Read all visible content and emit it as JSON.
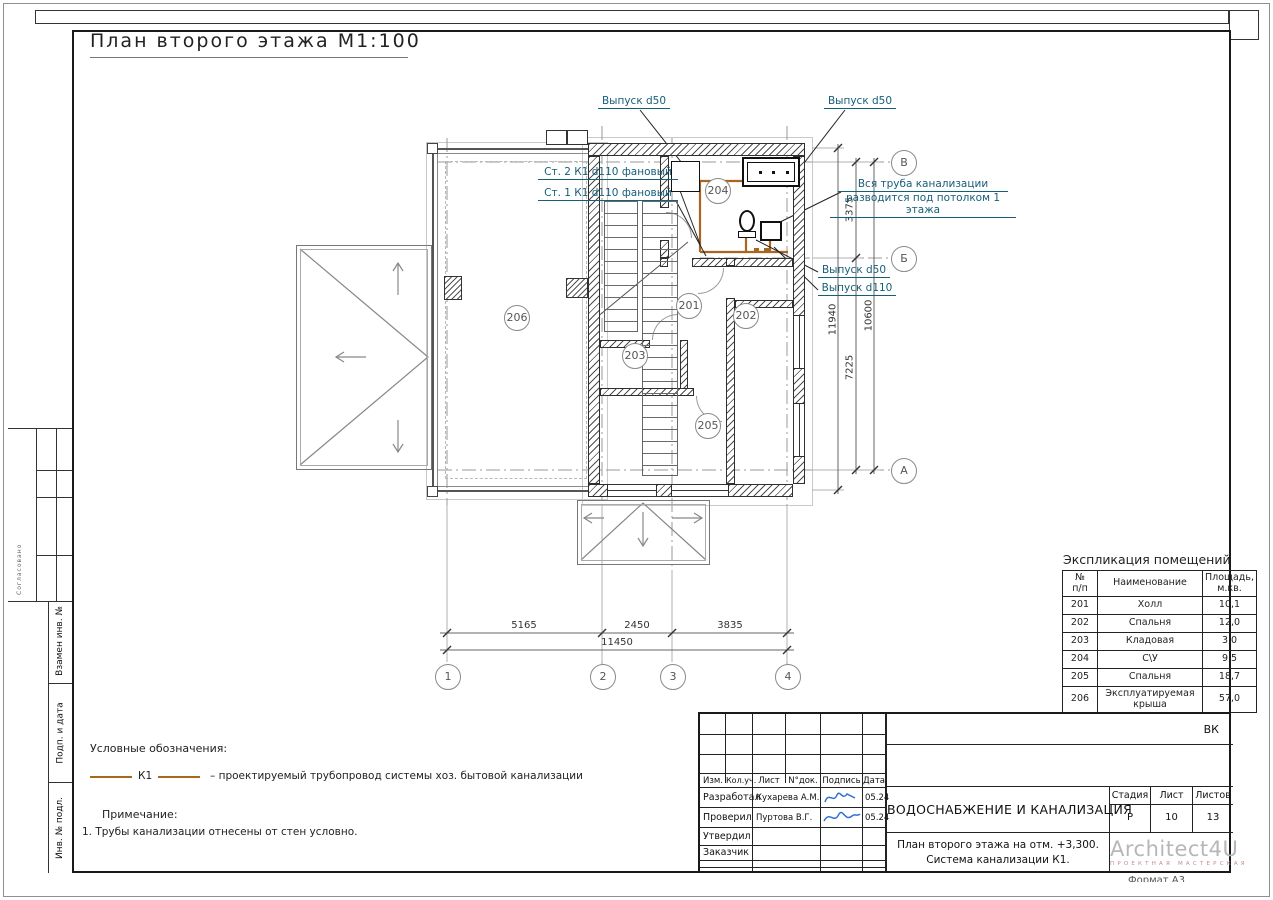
{
  "page": {
    "title": "План второго этажа М1:100",
    "format_note": "Формат А3"
  },
  "colors": {
    "pipe": "#a8671f",
    "annotation": "#155e78",
    "signature": "#2f6fd6",
    "logo_gray": "#b7b7b7",
    "logo_red": "#c48b8b"
  },
  "plan": {
    "rooms": {
      "r201": "201",
      "r202": "202",
      "r203": "203",
      "r204": "204",
      "r205": "205",
      "r206": "206"
    },
    "axes": {
      "c1": "1",
      "c2": "2",
      "c3": "3",
      "c4": "4",
      "rA": "А",
      "rB": "Б",
      "rV": "В"
    },
    "dims": {
      "b1": "5165",
      "b2": "2450",
      "b3": "3835",
      "btotal": "11450",
      "v1": "3375",
      "v2": "7225",
      "vtotal": "10600",
      "vouter": "11940"
    },
    "annotations": {
      "outlet50_left": "Выпуск d50",
      "outlet50_right": "Выпуск d50",
      "riser2": "Ст. 2 К1 d110 фановый",
      "riser1": "Ст. 1 К1 d110 фановый",
      "ceiling_note1": "Вся труба канализации",
      "ceiling_note2": "разводится под потолком 1 этажа",
      "outlet50_mid": "Выпуск d50",
      "outlet110": "Выпуск d110"
    }
  },
  "legend": {
    "heading": "Условные обозначения:",
    "k1_label": "К1",
    "k1_desc": "– проектируемый трубопровод системы хоз. бытовой канализации",
    "note_heading": "Примечание:",
    "note1": "1. Трубы канализации отнесены  от стен условно."
  },
  "explication": {
    "title": "Экспликация помещений",
    "headers": {
      "num": "№\nп/п",
      "name": "Наименование",
      "area": "Площадь,\nм.кв."
    },
    "rows": [
      {
        "num": "201",
        "name": "Холл",
        "area": "10,1"
      },
      {
        "num": "202",
        "name": "Спальня",
        "area": "12,0"
      },
      {
        "num": "203",
        "name": "Кладовая",
        "area": "3,0"
      },
      {
        "num": "204",
        "name": "С\\У",
        "area": "9,5"
      },
      {
        "num": "205",
        "name": "Спальня",
        "area": "18,7"
      },
      {
        "num": "206",
        "name": "Эксплуатируемая\nкрыша",
        "area": "57,0"
      }
    ]
  },
  "titleblock": {
    "doc_code": "ВК",
    "cols": {
      "izm": "Изм.",
      "koluch": "Кол.уч.",
      "list": "Лист",
      "ndok": "N°док.",
      "podpis": "Подпись",
      "data": "Дата"
    },
    "rows": {
      "r1": {
        "role": "Разработал",
        "name": "Кухарева А.М.",
        "date": "05.24"
      },
      "r2": {
        "role": "Проверил",
        "name": "Пуртова В.Г.",
        "date": "05.24"
      },
      "r3": {
        "role": "Утвердил"
      },
      "r4": {
        "role": "Заказчик"
      }
    },
    "project_title": "ВОДОСНАБЖЕНИЕ И КАНАЛИЗАЦИЯ",
    "sheet_title_1": "План второго этажа на отм. +3,300.",
    "sheet_title_2": "Система канализации К1.",
    "stage_h": "Стадия",
    "sheet_h": "Лист",
    "sheets_h": "Листов",
    "stage": "Р",
    "sheet": "10",
    "sheets": "13",
    "logo": "Architect4U",
    "logo_sub": "ПРОЕКТНАЯ МАСТЕРСКАЯ"
  },
  "sidebar": {
    "approve": "Согласовано",
    "l1": "Взамен инв. №",
    "l2": "Подп. и дата",
    "l3": "Инв. № подл."
  }
}
